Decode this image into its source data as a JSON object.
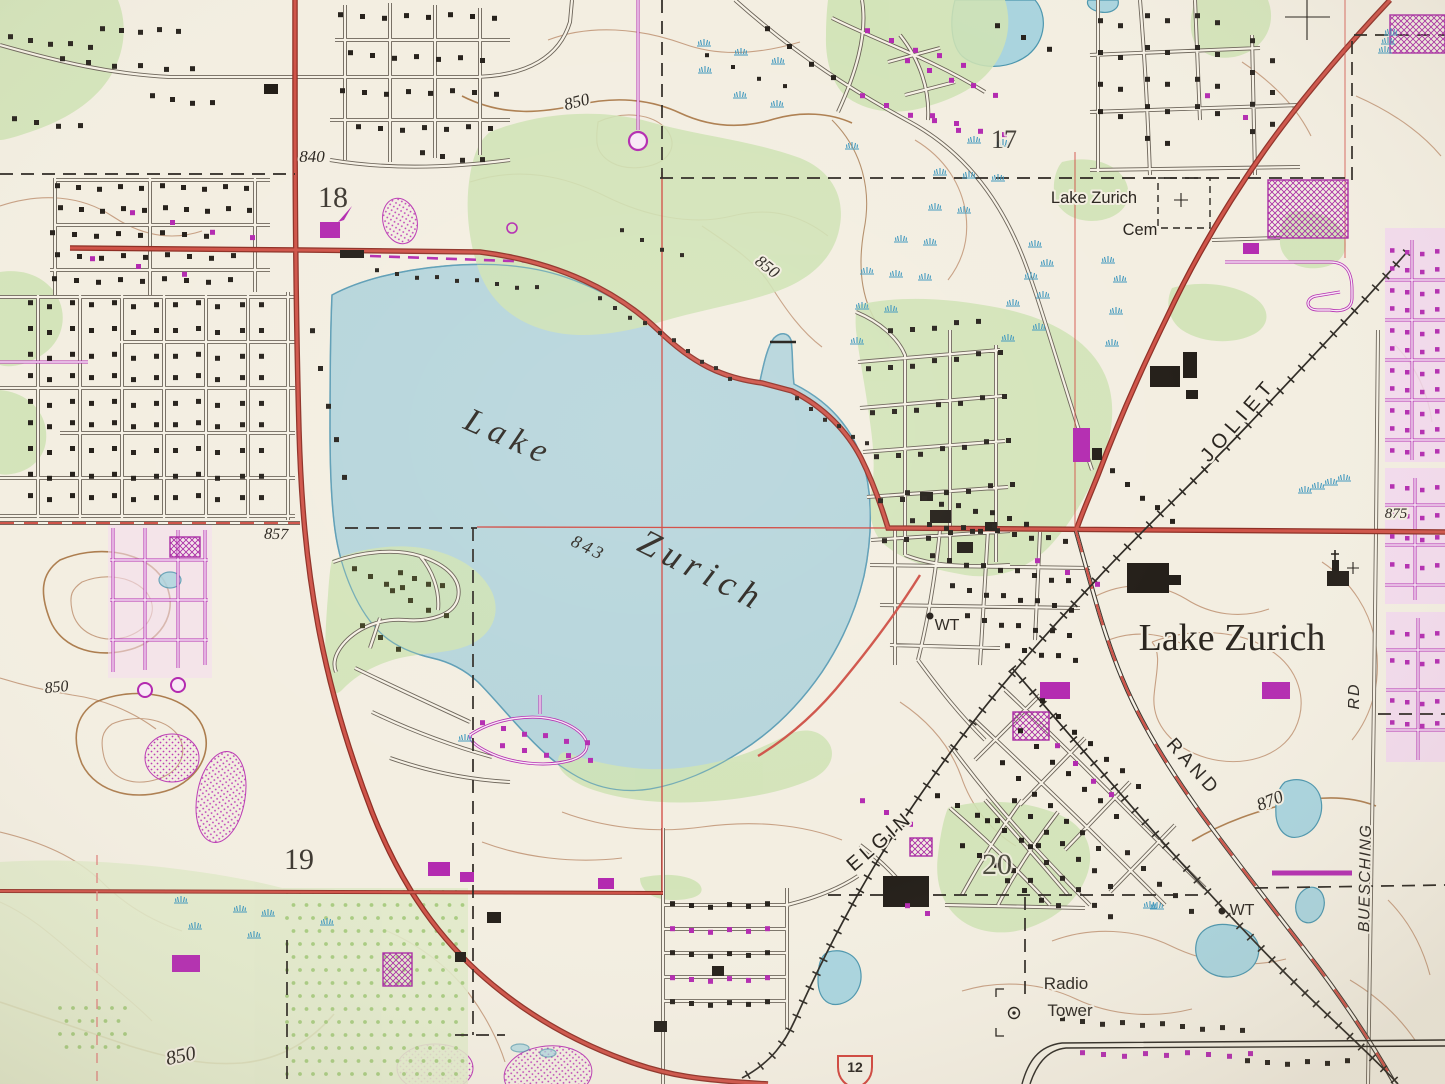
{
  "labels": {
    "lake_word1": "Lake",
    "lake_word2": "Zurich",
    "lake_elevation": "843",
    "town_name": "Lake Zurich",
    "cemetery_line1": "Lake Zurich",
    "cemetery_line2": "Cem",
    "road_joliet": "JOLIET",
    "road_elgin": "ELGIN",
    "road_rand": "RAND",
    "road_rd": "RD",
    "road_buesching": "BUESCHING",
    "radio_tower_line1": "Radio",
    "radio_tower_line2": "Tower",
    "water_tank_1": "WT",
    "water_tank_2": "WT",
    "section_17": "17",
    "section_18": "18",
    "section_19": "19",
    "section_20": "20",
    "contour_850_a": "850",
    "contour_850_b": "850",
    "contour_850_c": "850",
    "contour_850_d": "850",
    "contour_870": "870",
    "elevation_840": "840",
    "elevation_857": "857",
    "elevation_875": "875",
    "route_shield_12": "12"
  },
  "colors": {
    "background": "#f3eee1",
    "water": "#b6d5db",
    "water_outline": "#5d9db5",
    "woodland": "#cfe3b4",
    "orchard_dot": "#a8cb80",
    "contour": "#c49b7d",
    "contour_index": "#a5713f",
    "primary_road": "#cf5348",
    "road_casing": "#8e2f25",
    "revision_magenta": "#b32ab0",
    "urban_tint": "#f2d7ee",
    "railroad": "#2e2a24",
    "marsh_symbol": "#3e97bd",
    "section_number": "#e2574b",
    "house": "#26211b"
  }
}
